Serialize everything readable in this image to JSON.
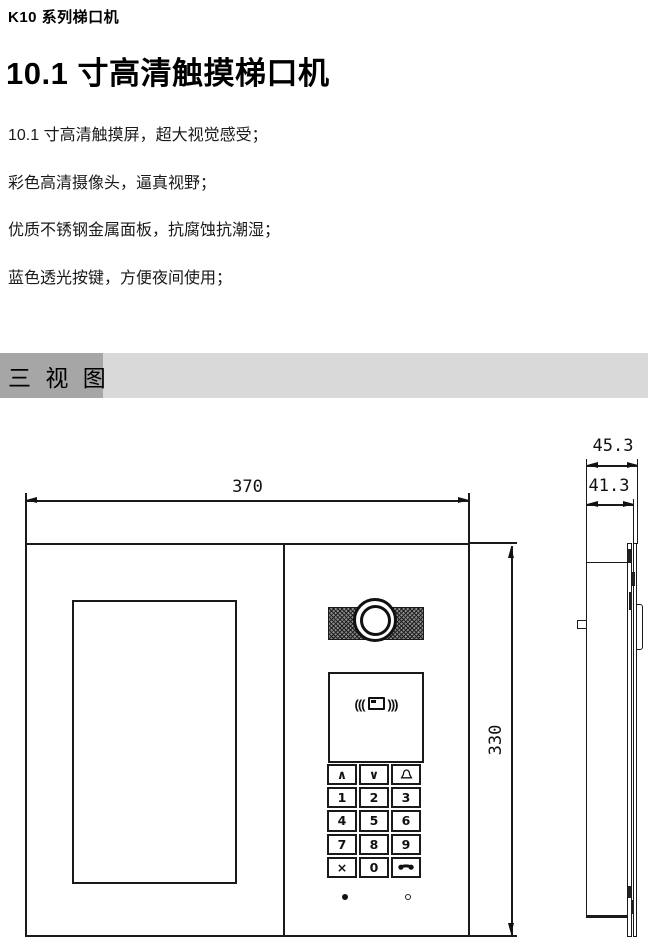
{
  "header": {
    "series_title": "K10 系列梯口机",
    "product_title": "10.1 寸高清触摸梯口机"
  },
  "features": [
    "10.1 寸高清触摸屏，超大视觉感受；",
    "彩色高清摄像头，逼真视野；",
    "优质不锈钢金属面板，抗腐蚀抗潮湿；",
    "蓝色透光按键，方便夜间使用；"
  ],
  "section": {
    "title": "三 视 图"
  },
  "drawing": {
    "front_view": {
      "width_label": "370",
      "height_label": "330",
      "card_reader": {
        "left_waves": "(((",
        "right_waves": ")))",
        "icon": "card-icon"
      },
      "keypad_keys": [
        "∧",
        "∨",
        "",
        "1",
        "2",
        "3",
        "4",
        "5",
        "6",
        "7",
        "8",
        "9",
        "×",
        "0",
        ""
      ],
      "keypad_icons": {
        "row1_col3": "bell-icon",
        "row5_col3": "phone-handset-icon"
      },
      "screws": {
        "left": "solid-dot",
        "right": "open-dot"
      }
    },
    "side_view": {
      "depth_total_label": "45.3",
      "depth_front_label": "41.3"
    }
  },
  "colors": {
    "line": "#1a1a1a",
    "text": "#000000",
    "section_bar_bg": "#d9d9d9",
    "section_bar_highlight": "#a6a6a6"
  }
}
